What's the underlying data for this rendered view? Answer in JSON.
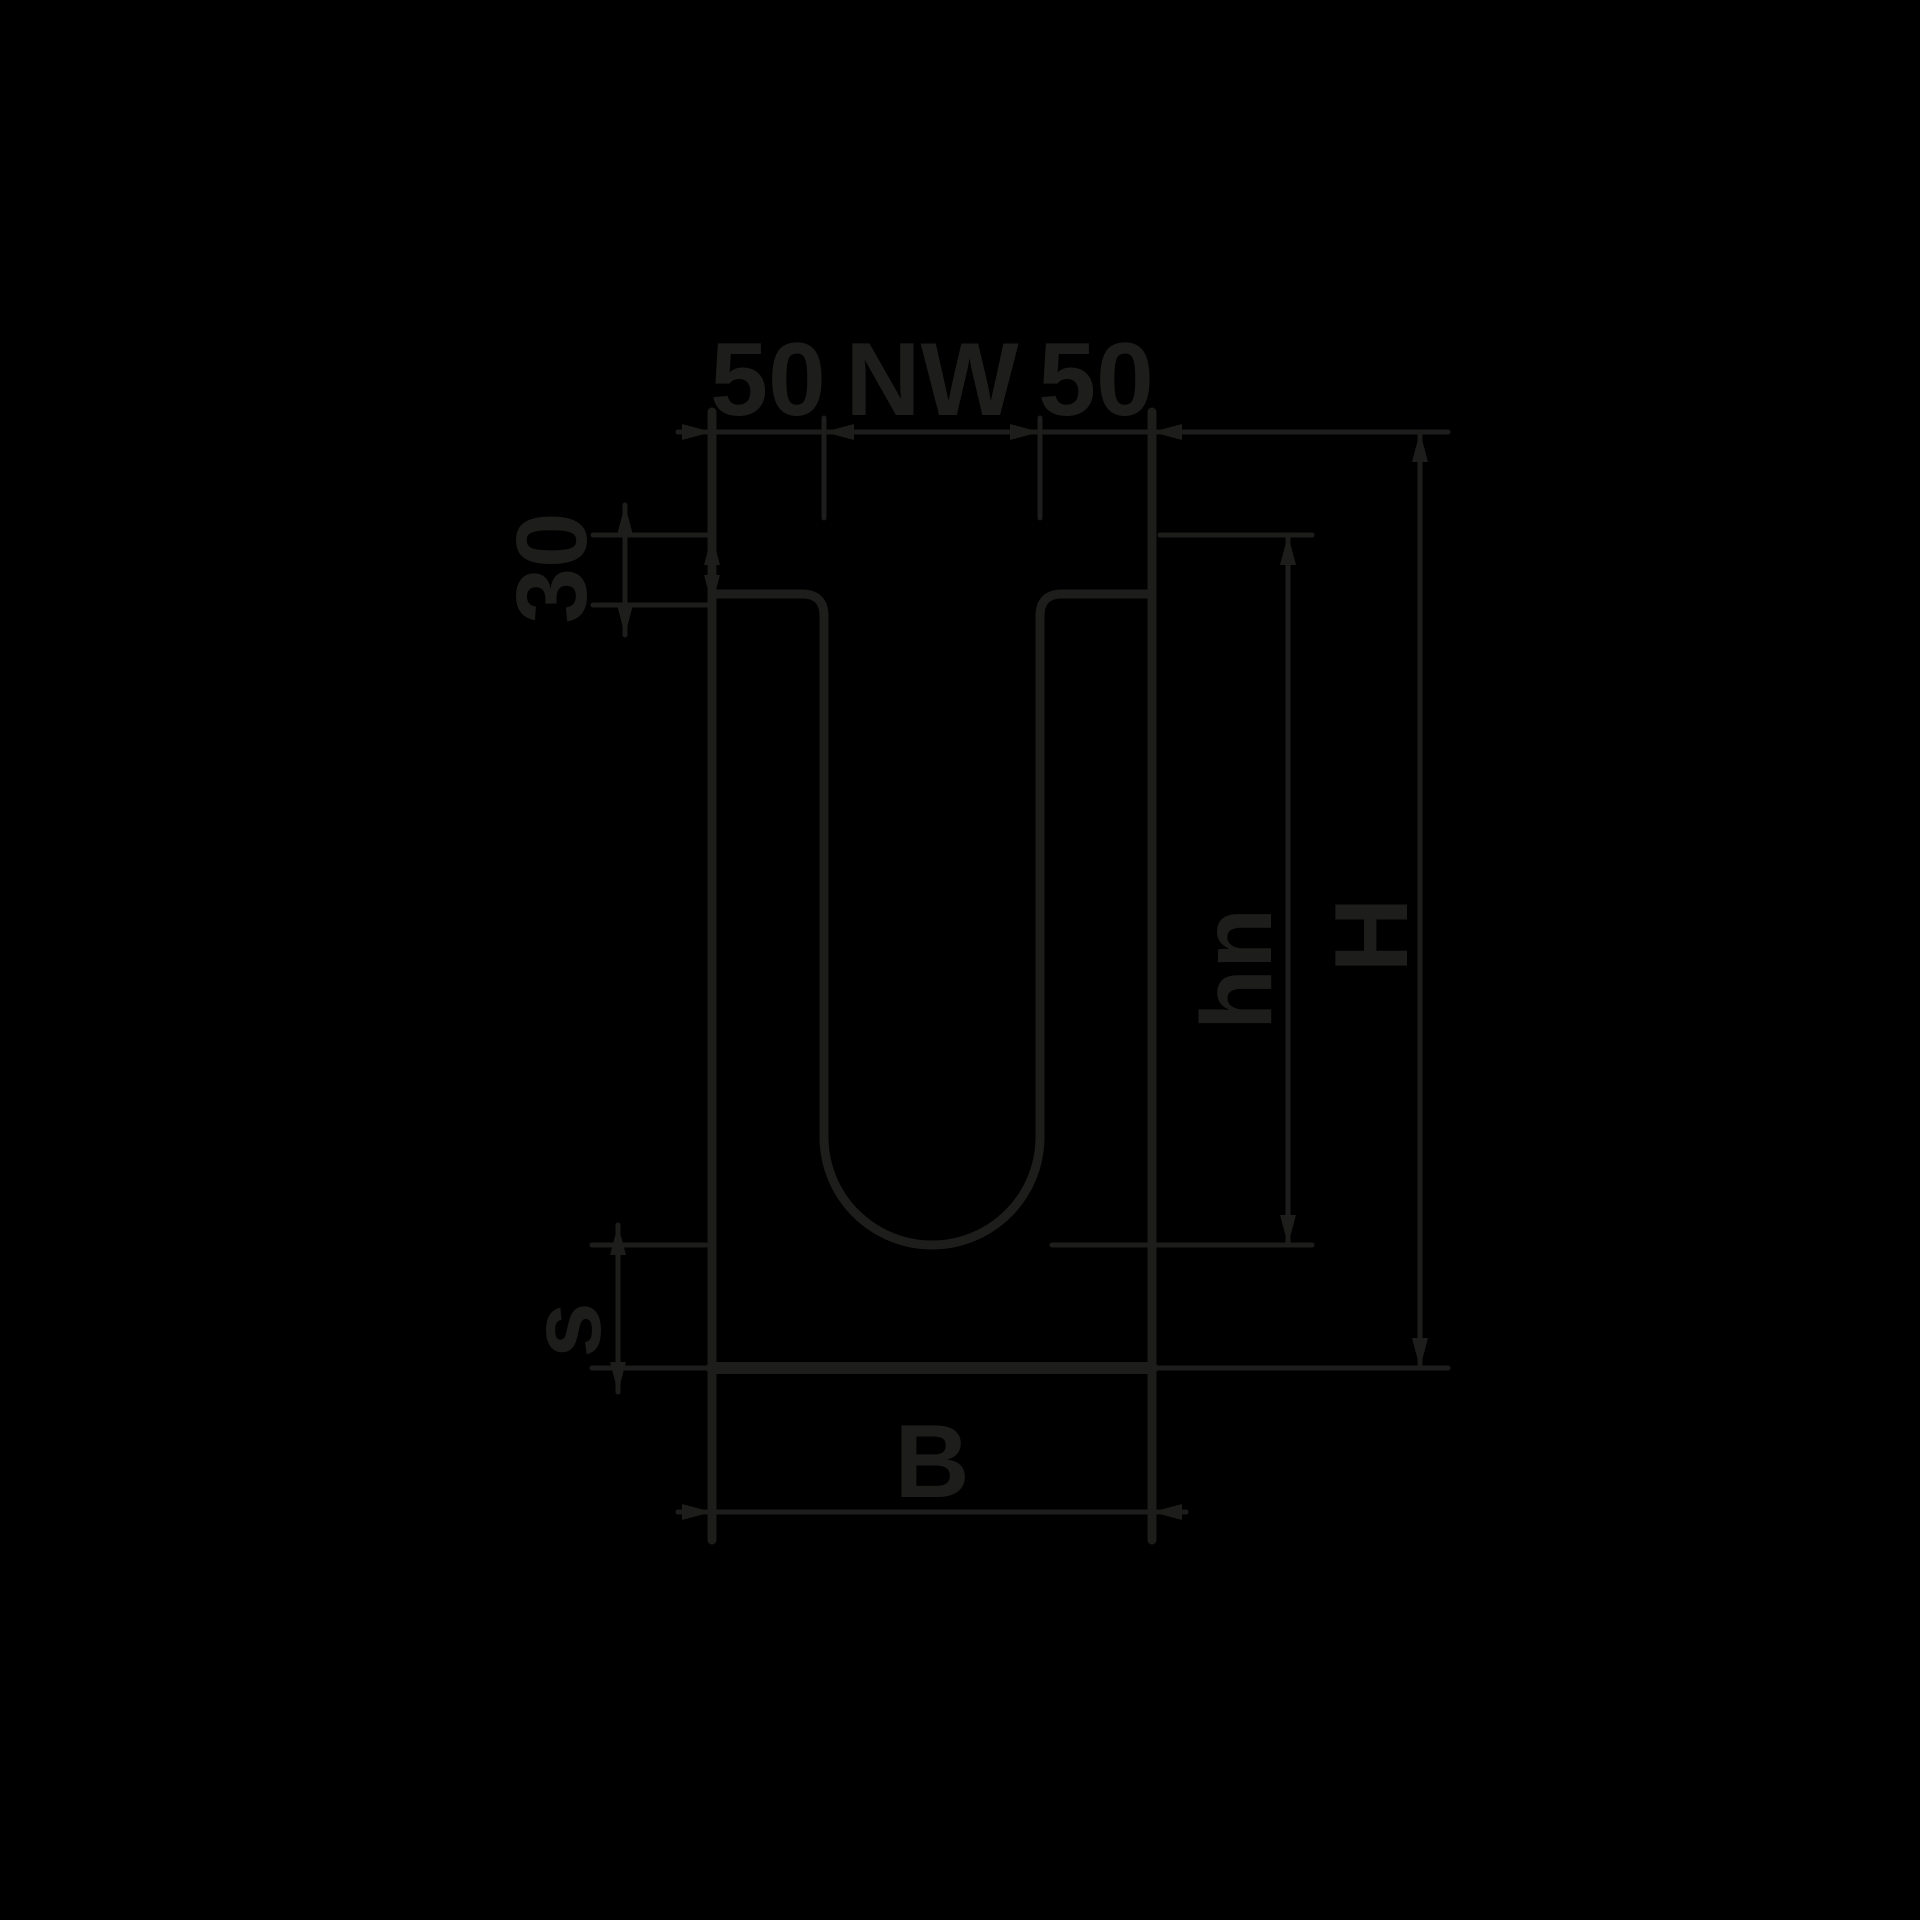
{
  "figure": {
    "background_color": "#000000",
    "line_color": "#1d1d1b"
  },
  "dimensions": {
    "wall_left": {
      "label": "50"
    },
    "nominal_width": {
      "label": "NW"
    },
    "wall_right": {
      "label": "50"
    },
    "rim_depth": {
      "label": "30"
    },
    "inner_depth": {
      "label": "hn"
    },
    "overall_height": {
      "label": "H"
    },
    "base_thickness": {
      "label": "s"
    },
    "overall_width": {
      "label": "B"
    }
  }
}
